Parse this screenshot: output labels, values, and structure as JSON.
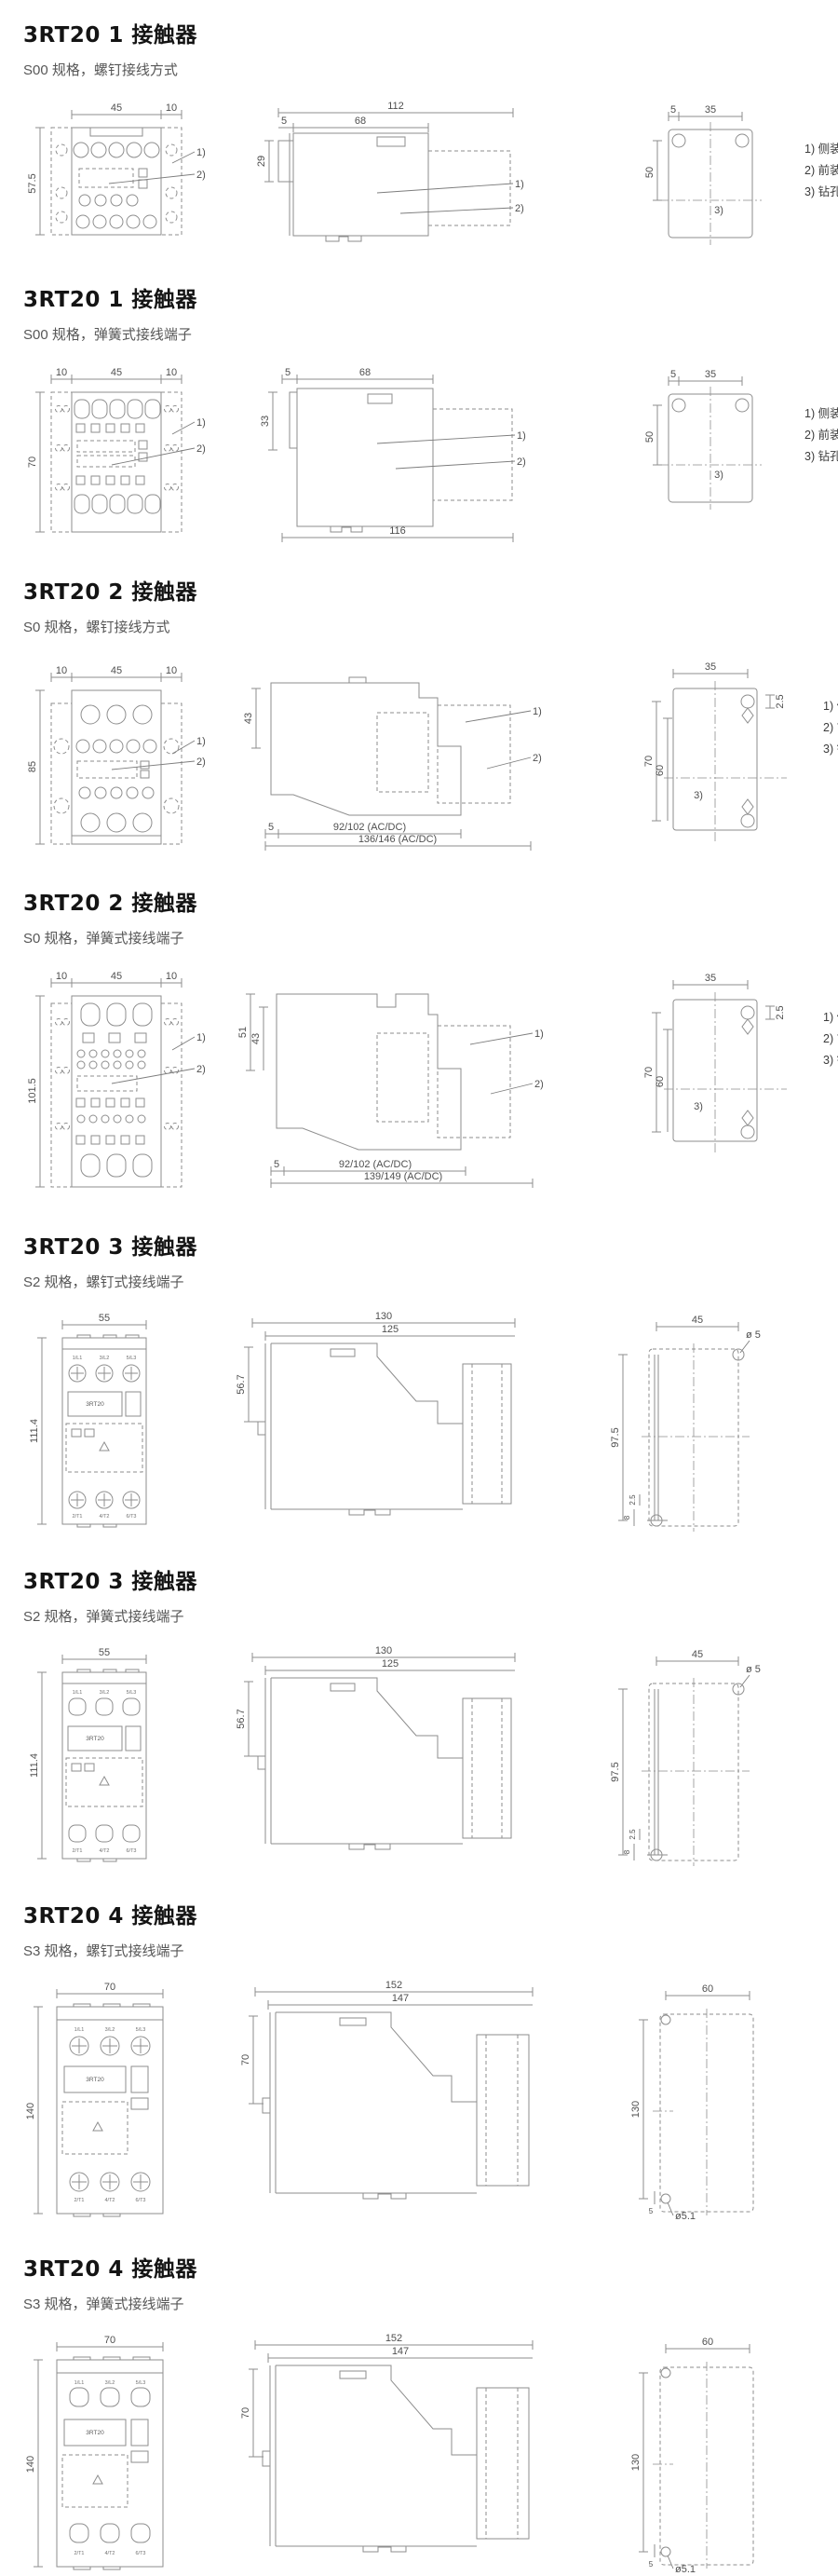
{
  "legend": {
    "l1": "1) 侧装辅助触头",
    "l2": "2) 前装辅助触头",
    "l3": "3) 钻孔图"
  },
  "sections": [
    {
      "title": "3RT20 1 接触器",
      "subtitle": "S00 规格，螺钉接线方式",
      "callout1": "1)",
      "callout2": "2)",
      "drill_label": "3)",
      "front": {
        "top1": "45",
        "top2": "10",
        "left": "57.5"
      },
      "side": {
        "top_main": "112",
        "top_sub1": "5",
        "top_sub2": "68",
        "left": "29"
      },
      "drill": {
        "top1": "5",
        "top2": "35",
        "left": "50"
      }
    },
    {
      "title": "3RT20 1 接触器",
      "subtitle": "S00 规格，弹簧式接线端子",
      "callout1": "1)",
      "callout2": "2)",
      "drill_label": "3)",
      "front": {
        "top1": "10",
        "top2": "45",
        "top3": "10",
        "left": "70"
      },
      "side": {
        "top_sub1": "5",
        "top_sub2": "68",
        "left": "33",
        "bottom": "116"
      },
      "drill": {
        "top1": "5",
        "top2": "35",
        "left": "50"
      }
    },
    {
      "title": "3RT20 2 接触器",
      "subtitle": "S0 规格，螺钉接线方式",
      "callout1": "1)",
      "callout2": "2)",
      "drill_label": "3)",
      "front": {
        "top1": "10",
        "top2": "45",
        "top3": "10",
        "left": "85"
      },
      "side": {
        "left1": "43",
        "bottom1": "5",
        "bottom2": "92/102 (AC/DC)",
        "bottom3": "136/146 (AC/DC)"
      },
      "drill": {
        "top": "35",
        "right": "2.5",
        "left1": "70",
        "left2": "60"
      }
    },
    {
      "title": "3RT20 2 接触器",
      "subtitle": "S0 规格，弹簧式接线端子",
      "callout1": "1)",
      "callout2": "2)",
      "drill_label": "3)",
      "front": {
        "top1": "10",
        "top2": "45",
        "top3": "10",
        "left": "101.5"
      },
      "side": {
        "left1": "51",
        "left2": "43",
        "bottom1": "5",
        "bottom2": "92/102 (AC/DC)",
        "bottom3": "139/149 (AC/DC)"
      },
      "drill": {
        "top": "35",
        "right": "2.5",
        "left1": "70",
        "left2": "60"
      }
    },
    {
      "title": "3RT20 3 接触器",
      "subtitle": "S2 规格，螺钉式接线端子",
      "front": {
        "top": "55",
        "left": "111.4",
        "t1": "1/L1",
        "t2": "3/L2",
        "t3": "5/L3",
        "b1": "2/T1",
        "b2": "4/T2",
        "b3": "6/T3",
        "brand": "3RT20"
      },
      "side": {
        "top1": "130",
        "top2": "125",
        "left": "56.7"
      },
      "drill": {
        "top": "45",
        "hole": "ø 5",
        "left": "97.5",
        "bl1": "2.5",
        "bl2": "8"
      }
    },
    {
      "title": "3RT20 3 接触器",
      "subtitle": "S2 规格，弹簧式接线端子",
      "front": {
        "top": "55",
        "left": "111.4",
        "t1": "1/L1",
        "t2": "3/L2",
        "t3": "5/L3",
        "b1": "2/T1",
        "b2": "4/T2",
        "b3": "6/T3",
        "brand": "3RT20"
      },
      "side": {
        "top1": "130",
        "top2": "125",
        "left": "56.7"
      },
      "drill": {
        "top": "45",
        "hole": "ø 5",
        "left": "97.5",
        "bl1": "2.5",
        "bl2": "8"
      }
    },
    {
      "title": "3RT20 4 接触器",
      "subtitle": "S3 规格，螺钉式接线端子",
      "front": {
        "top": "70",
        "left": "140",
        "t1": "1/L1",
        "t2": "3/L2",
        "t3": "5/L3",
        "b1": "2/T1",
        "b2": "4/T2",
        "b3": "6/T3",
        "brand": "3RT20"
      },
      "side": {
        "top1": "152",
        "top2": "147",
        "left": "70"
      },
      "drill": {
        "top": "60",
        "left": "130",
        "hole": "ø5.1",
        "bl1": "5"
      }
    },
    {
      "title": "3RT20 4 接触器",
      "subtitle": "S3 规格，弹簧式接线端子",
      "front": {
        "top": "70",
        "left": "140",
        "t1": "1/L1",
        "t2": "3/L2",
        "t3": "5/L3",
        "b1": "2/T1",
        "b2": "4/T2",
        "b3": "6/T3",
        "brand": "3RT20"
      },
      "side": {
        "top1": "152",
        "top2": "147",
        "left": "70"
      },
      "drill": {
        "top": "60",
        "left": "130",
        "hole": "ø5.1",
        "bl1": "5"
      }
    }
  ]
}
